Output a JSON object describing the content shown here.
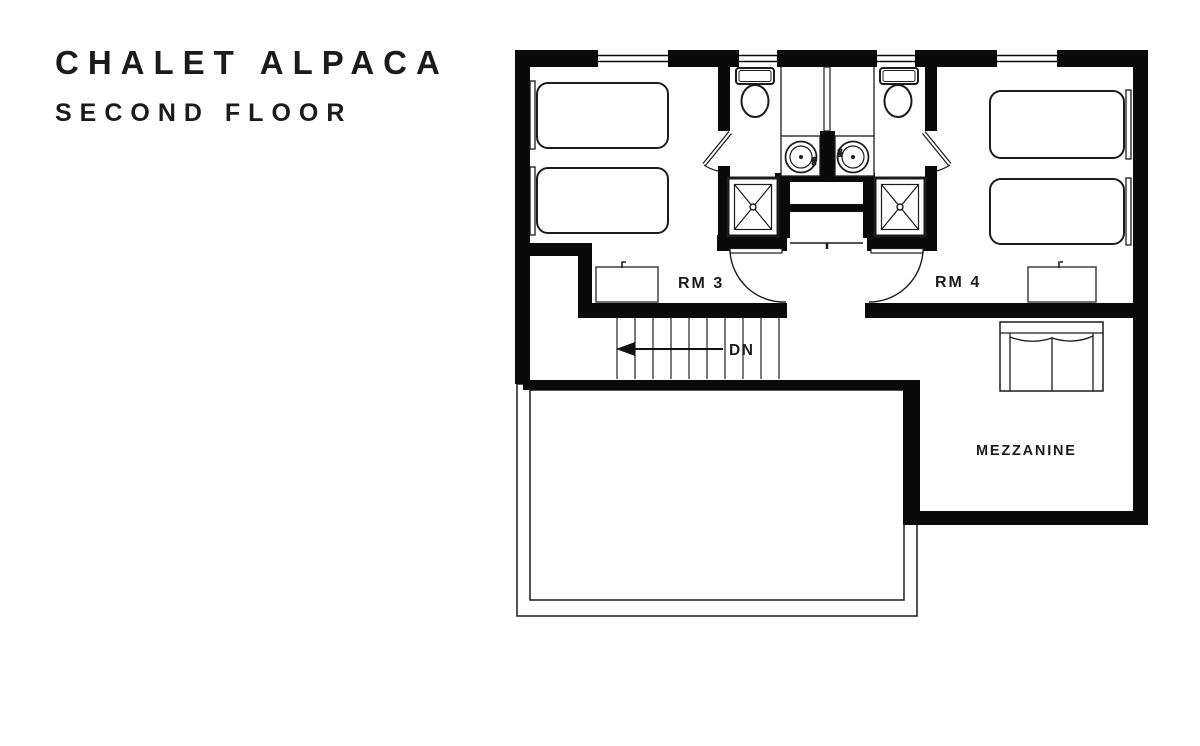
{
  "header": {
    "title": "CHALET ALPACA",
    "subtitle": "SECOND FLOOR"
  },
  "plan": {
    "labels": {
      "rm3": "RM 3",
      "rm4": "RM 4",
      "down": "DN",
      "mezzanine": "MEZZANINE"
    },
    "fixture_labels": {
      "sink_left": "960",
      "sink_right": "960"
    },
    "rooms": [
      {
        "id": "rm3",
        "label": "RM 3",
        "fixtures": [
          "single-bed",
          "single-bed",
          "dresser"
        ]
      },
      {
        "id": "bathroom-left",
        "fixtures": [
          "toilet",
          "sink",
          "shower"
        ]
      },
      {
        "id": "bathroom-right",
        "fixtures": [
          "toilet",
          "sink",
          "shower"
        ]
      },
      {
        "id": "rm4",
        "label": "RM 4",
        "fixtures": [
          "single-bed",
          "single-bed",
          "dresser"
        ]
      },
      {
        "id": "mezzanine",
        "label": "MEZZANINE",
        "fixtures": [
          "sofa"
        ]
      },
      {
        "id": "stair-hall",
        "label": "DN",
        "fixtures": [
          "staircase-down"
        ]
      }
    ],
    "colors": {
      "wall": "#0a0a0a",
      "line": "#1c1c1c",
      "stair_line": "#4d4d4d",
      "text": "#1b1b1b",
      "background": "#ffffff"
    }
  }
}
